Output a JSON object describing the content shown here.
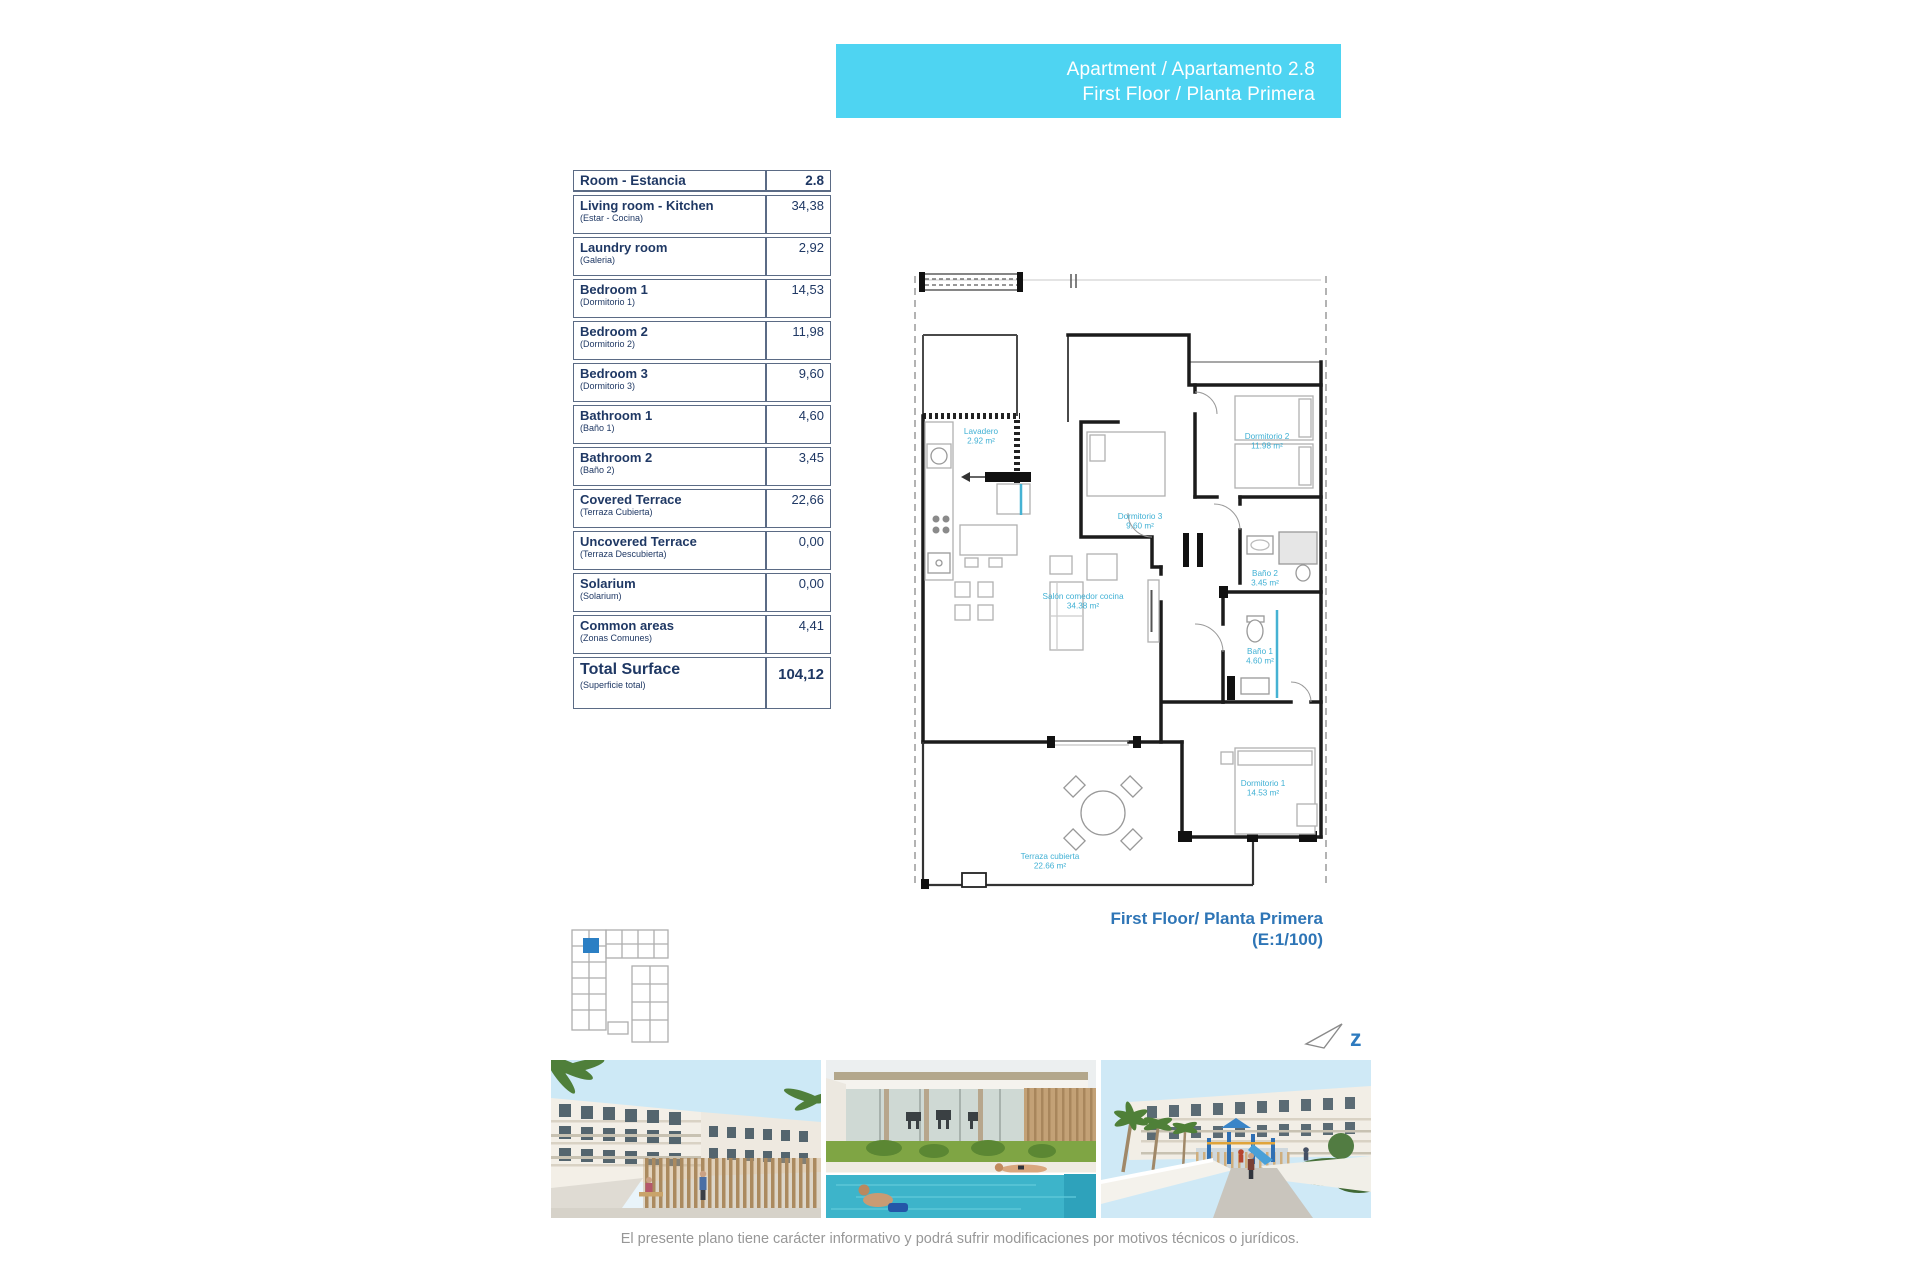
{
  "banner": {
    "line1": "Apartment / Apartamento 2.8",
    "line2": "First Floor / Planta Primera"
  },
  "area_table": {
    "header_label": "Room - Estancia",
    "header_value": "2.8",
    "rows": [
      {
        "label": "Living room - Kitchen",
        "sublabel": "(Estar - Cocina)",
        "value": "34,38"
      },
      {
        "label": "Laundry room",
        "sublabel": "(Galeria)",
        "value": "2,92"
      },
      {
        "label": "Bedroom 1",
        "sublabel": "(Dormitorio 1)",
        "value": "14,53"
      },
      {
        "label": "Bedroom 2",
        "sublabel": "(Dormitorio 2)",
        "value": "11,98"
      },
      {
        "label": "Bedroom 3",
        "sublabel": "(Dormitorio 3)",
        "value": "9,60"
      },
      {
        "label": "Bathroom 1",
        "sublabel": "(Baño 1)",
        "value": "4,60"
      },
      {
        "label": "Bathroom 2",
        "sublabel": "(Baño 2)",
        "value": "3,45"
      },
      {
        "label": "Covered Terrace",
        "sublabel": "(Terraza Cubierta)",
        "value": "22,66"
      },
      {
        "label": "Uncovered Terrace",
        "sublabel": "(Terraza Descubierta)",
        "value": "0,00"
      },
      {
        "label": "Solarium",
        "sublabel": "(Solarium)",
        "value": "0,00"
      },
      {
        "label": "Common areas",
        "sublabel": "(Zonas Comunes)",
        "value": "4,41"
      }
    ],
    "total_label": "Total Surface",
    "total_sublabel": "(Superficie total)",
    "total_value": "104,12"
  },
  "floor_plan": {
    "rooms": [
      {
        "name": "Lavadero",
        "area": "2.92 m²"
      },
      {
        "name": "Dormitorio 3",
        "area": "9.60 m²"
      },
      {
        "name": "Dormitorio 2",
        "area": "11.98 m²"
      },
      {
        "name": "Baño 2",
        "area": "3.45 m²"
      },
      {
        "name": "Baño 1",
        "area": "4.60 m²"
      },
      {
        "name": "Salón comedor cocina",
        "area": "34.38 m²"
      },
      {
        "name": "Dormitorio 1",
        "area": "14.53 m²"
      },
      {
        "name": "Terraza cubierta",
        "area": "22.66 m²"
      }
    ],
    "caption_line1": "First Floor/ Planta Primera",
    "caption_line2": "(E:1/100)",
    "north_mark": "z"
  },
  "disclaimer": "El presente plano tiene carácter informativo y podrá sufrir modificaciones por motivos técnicos o jurídicos.",
  "colors": {
    "banner_bg": "#4ed4f2",
    "table_text": "#1f3864",
    "plan_label": "#3fb0d4",
    "caption_blue": "#2e75b6",
    "keyplan_highlight": "#2b7fc4",
    "pool": "#3db4ca"
  }
}
